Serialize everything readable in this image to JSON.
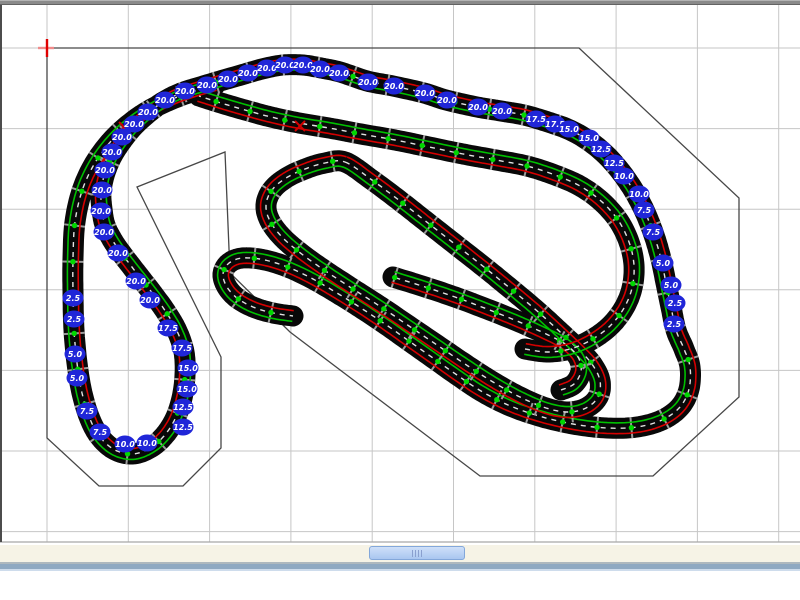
{
  "window": {
    "app_hint": "track-designer"
  },
  "canvas": {
    "top": 5,
    "bottom": 542,
    "width": 800,
    "grid": {
      "color": "#c6c6c6",
      "vertical_x": [
        47,
        128.3,
        209.6,
        290.9,
        372.2,
        453.5,
        534.8,
        616.1,
        697.4,
        778.7
      ],
      "horizontal_y": [
        48,
        128.6,
        209.2,
        289.8,
        370.4,
        451,
        531.6
      ],
      "bottom_edge_color": "#a8a8a8"
    },
    "table_outline": {
      "color": "#474747",
      "points": [
        [
          47,
          48
        ],
        [
          579,
          48
        ],
        [
          739,
          198
        ],
        [
          739,
          397
        ],
        [
          653,
          476
        ],
        [
          480,
          476
        ],
        [
          290,
          332
        ],
        [
          230,
          273
        ],
        [
          225,
          152
        ],
        [
          137,
          187
        ],
        [
          221,
          357
        ],
        [
          221,
          448
        ],
        [
          183,
          486
        ],
        [
          99,
          486
        ],
        [
          47,
          438
        ]
      ]
    },
    "origin_marker": {
      "x": 47,
      "y": 48,
      "color": "#e00000",
      "halo_color": "#f08a8a"
    }
  },
  "track": {
    "style": {
      "band_color": "#080808",
      "band_width": 21,
      "lane_left_color": "#d40000",
      "lane_right_color": "#00c000",
      "lane_offset": 5.4,
      "lane_width": 1.6,
      "center_dash_color": "#e2e2e2",
      "center_dash_width": 1.4,
      "center_dash": "5 5",
      "joint_tick_color": "#9b9b9b",
      "joint_tick_halflen": 10.5,
      "joint_dot_color": "#00d800",
      "joint_dot_radius": 2.7,
      "joint_spacing": 34
    },
    "paths": [
      {
        "name": "outer-circuit-with-flyover",
        "closed": false,
        "points": [
          [
            215,
            85
          ],
          [
            180,
            96
          ],
          [
            148,
            111
          ],
          [
            120,
            132
          ],
          [
            98,
            158
          ],
          [
            83,
            188
          ],
          [
            75,
            222
          ],
          [
            73,
            258
          ],
          [
            73,
            295
          ],
          [
            74,
            330
          ],
          [
            77,
            363
          ],
          [
            82,
            393
          ],
          [
            90,
            419
          ],
          [
            100,
            437
          ],
          [
            115,
            450
          ],
          [
            133,
            454
          ],
          [
            150,
            448
          ],
          [
            164,
            436
          ],
          [
            175,
            419
          ],
          [
            182,
            398
          ],
          [
            185,
            375
          ],
          [
            184,
            352
          ],
          [
            177,
            331
          ],
          [
            166,
            312
          ],
          [
            153,
            294
          ],
          [
            139,
            276
          ],
          [
            125,
            258
          ],
          [
            113,
            241
          ],
          [
            105,
            225
          ],
          [
            102,
            209
          ],
          [
            101,
            193
          ],
          [
            104,
            176
          ],
          [
            111,
            158
          ],
          [
            121,
            142
          ],
          [
            133,
            127
          ],
          [
            147,
            114
          ],
          [
            163,
            102
          ],
          [
            181,
            93
          ],
          [
            200,
            87
          ],
          [
            220,
            81
          ],
          [
            241,
            75
          ],
          [
            262,
            69
          ],
          [
            283,
            65
          ],
          [
            303,
            65
          ],
          [
            321,
            68
          ],
          [
            340,
            72
          ],
          [
            367,
            81
          ],
          [
            393,
            86
          ],
          [
            424,
            93
          ],
          [
            446,
            100
          ],
          [
            477,
            107
          ],
          [
            501,
            111
          ],
          [
            524,
            115
          ],
          [
            548,
            122
          ],
          [
            570,
            130
          ],
          [
            589,
            141
          ],
          [
            606,
            155
          ],
          [
            621,
            172
          ],
          [
            634,
            191
          ],
          [
            645,
            212
          ],
          [
            654,
            235
          ],
          [
            661,
            259
          ],
          [
            666,
            283
          ],
          [
            671,
            307
          ],
          [
            676,
            330
          ],
          [
            684,
            349
          ],
          [
            690,
            367
          ],
          [
            689,
            389
          ],
          [
            680,
            407
          ],
          [
            662,
            420
          ],
          [
            637,
            427
          ],
          [
            607,
            428
          ],
          [
            573,
            424
          ],
          [
            539,
            416
          ],
          [
            508,
            405
          ],
          [
            481,
            391
          ],
          [
            457,
            375
          ],
          [
            433,
            358
          ],
          [
            409,
            341
          ],
          [
            385,
            324
          ],
          [
            361,
            308
          ],
          [
            337,
            293
          ],
          [
            313,
            279
          ],
          [
            290,
            268
          ],
          [
            269,
            261
          ],
          [
            251,
            258
          ],
          [
            237,
            259
          ],
          [
            227,
            265
          ],
          [
            223,
            275
          ],
          [
            227,
            287
          ],
          [
            237,
            298
          ],
          [
            253,
            307
          ],
          [
            273,
            313
          ],
          [
            293,
            316
          ]
        ]
      },
      {
        "name": "center-kidney-loop",
        "closed": true,
        "points": [
          [
            345,
            162
          ],
          [
            372,
            180
          ],
          [
            400,
            201
          ],
          [
            428,
            223
          ],
          [
            456,
            245
          ],
          [
            484,
            267
          ],
          [
            511,
            289
          ],
          [
            536,
            310
          ],
          [
            558,
            330
          ],
          [
            577,
            348
          ],
          [
            592,
            364
          ],
          [
            600,
            381
          ],
          [
            598,
            397
          ],
          [
            586,
            408
          ],
          [
            568,
            412
          ],
          [
            546,
            408
          ],
          [
            520,
            397
          ],
          [
            493,
            382
          ],
          [
            465,
            364
          ],
          [
            437,
            345
          ],
          [
            409,
            326
          ],
          [
            381,
            307
          ],
          [
            353,
            289
          ],
          [
            327,
            272
          ],
          [
            303,
            255
          ],
          [
            283,
            238
          ],
          [
            270,
            221
          ],
          [
            266,
            205
          ],
          [
            272,
            190
          ],
          [
            286,
            178
          ],
          [
            305,
            169
          ],
          [
            325,
            163
          ]
        ]
      },
      {
        "name": "inner-spiral-arm",
        "closed": false,
        "points": [
          [
            561,
            390
          ],
          [
            574,
            384
          ],
          [
            581,
            371
          ],
          [
            578,
            357
          ],
          [
            565,
            344
          ],
          [
            544,
            333
          ],
          [
            517,
            321
          ],
          [
            487,
            309
          ],
          [
            455,
            297
          ],
          [
            422,
            286
          ],
          [
            393,
            277
          ]
        ]
      },
      {
        "name": "middle-straight-and-curl",
        "closed": false,
        "points": [
          [
            525,
            349
          ],
          [
            547,
            352
          ],
          [
            570,
            349
          ],
          [
            591,
            340
          ],
          [
            610,
            326
          ],
          [
            624,
            308
          ],
          [
            632,
            288
          ],
          [
            634,
            265
          ],
          [
            629,
            242
          ],
          [
            618,
            220
          ],
          [
            601,
            201
          ],
          [
            580,
            186
          ],
          [
            555,
            175
          ],
          [
            527,
            166
          ],
          [
            496,
            160
          ],
          [
            463,
            154
          ],
          [
            429,
            147
          ],
          [
            395,
            140
          ],
          [
            361,
            134
          ],
          [
            329,
            128
          ],
          [
            299,
            123
          ],
          [
            271,
            117
          ],
          [
            245,
            110
          ],
          [
            221,
            103
          ],
          [
            199,
            96
          ]
        ]
      }
    ]
  },
  "elevation_labels": {
    "style": {
      "fill": "#2026d8",
      "text_color": "#ffffff",
      "rx": 10.5,
      "ry": 8.5,
      "font_size": 8
    },
    "items": [
      {
        "v": "20.0",
        "x": 150,
        "y": 300
      },
      {
        "v": "20.0",
        "x": 136,
        "y": 281
      },
      {
        "v": "20.0",
        "x": 118,
        "y": 253
      },
      {
        "v": "20.0",
        "x": 104,
        "y": 232
      },
      {
        "v": "20.0",
        "x": 101,
        "y": 211
      },
      {
        "v": "20.0",
        "x": 102,
        "y": 190
      },
      {
        "v": "20.0",
        "x": 105,
        "y": 170
      },
      {
        "v": "20.0",
        "x": 112,
        "y": 152
      },
      {
        "v": "20.0",
        "x": 122,
        "y": 137
      },
      {
        "v": "20.0",
        "x": 134,
        "y": 124
      },
      {
        "v": "20.0",
        "x": 148,
        "y": 112
      },
      {
        "v": "20.0",
        "x": 165,
        "y": 100
      },
      {
        "v": "20.0",
        "x": 185,
        "y": 91
      },
      {
        "v": "20.0",
        "x": 207,
        "y": 85
      },
      {
        "v": "20.0",
        "x": 228,
        "y": 79
      },
      {
        "v": "20.0",
        "x": 248,
        "y": 73
      },
      {
        "v": "20.0",
        "x": 267,
        "y": 68
      },
      {
        "v": "20.0",
        "x": 285,
        "y": 65
      },
      {
        "v": "20.0",
        "x": 303,
        "y": 65
      },
      {
        "v": "20.0",
        "x": 320,
        "y": 69
      },
      {
        "v": "20.0",
        "x": 339,
        "y": 73
      },
      {
        "v": "20.0",
        "x": 368,
        "y": 82
      },
      {
        "v": "20.0",
        "x": 394,
        "y": 86
      },
      {
        "v": "20.0",
        "x": 425,
        "y": 93
      },
      {
        "v": "20.0",
        "x": 447,
        "y": 100
      },
      {
        "v": "20.0",
        "x": 478,
        "y": 107
      },
      {
        "v": "20.0",
        "x": 502,
        "y": 111
      },
      {
        "v": "17.5",
        "x": 536,
        "y": 119
      },
      {
        "v": "17.5",
        "x": 555,
        "y": 124
      },
      {
        "v": "15.0",
        "x": 569,
        "y": 129
      },
      {
        "v": "15.0",
        "x": 589,
        "y": 138
      },
      {
        "v": "12.5",
        "x": 601,
        "y": 149
      },
      {
        "v": "12.5",
        "x": 614,
        "y": 163
      },
      {
        "v": "10.0",
        "x": 624,
        "y": 176
      },
      {
        "v": "10.0",
        "x": 639,
        "y": 194
      },
      {
        "v": "7.5",
        "x": 644,
        "y": 210
      },
      {
        "v": "7.5",
        "x": 653,
        "y": 232
      },
      {
        "v": "5.0",
        "x": 663,
        "y": 263
      },
      {
        "v": "5.0",
        "x": 671,
        "y": 285
      },
      {
        "v": "2.5",
        "x": 675,
        "y": 303
      },
      {
        "v": "2.5",
        "x": 674,
        "y": 324
      },
      {
        "v": "2.5",
        "x": 73,
        "y": 298
      },
      {
        "v": "2.5",
        "x": 74,
        "y": 319
      },
      {
        "v": "5.0",
        "x": 75,
        "y": 354
      },
      {
        "v": "5.0",
        "x": 77,
        "y": 378
      },
      {
        "v": "7.5",
        "x": 87,
        "y": 411
      },
      {
        "v": "7.5",
        "x": 100,
        "y": 432
      },
      {
        "v": "10.0",
        "x": 125,
        "y": 444
      },
      {
        "v": "10.0",
        "x": 147,
        "y": 443
      },
      {
        "v": "12.5",
        "x": 183,
        "y": 427
      },
      {
        "v": "12.5",
        "x": 183,
        "y": 407
      },
      {
        "v": "15.0",
        "x": 187,
        "y": 389
      },
      {
        "v": "15.0",
        "x": 188,
        "y": 368
      },
      {
        "v": "17.5",
        "x": 182,
        "y": 348
      },
      {
        "v": "17.5",
        "x": 168,
        "y": 328
      }
    ]
  },
  "markers": {
    "red_cross_color": "#d40000",
    "red_crosses": [
      [
        124,
        127
      ],
      [
        300,
        126
      ]
    ]
  },
  "scrollbar": {
    "track_color": "#f6f3e6",
    "thumb": {
      "x": 369,
      "y": 546,
      "width": 96,
      "height": 14
    }
  }
}
